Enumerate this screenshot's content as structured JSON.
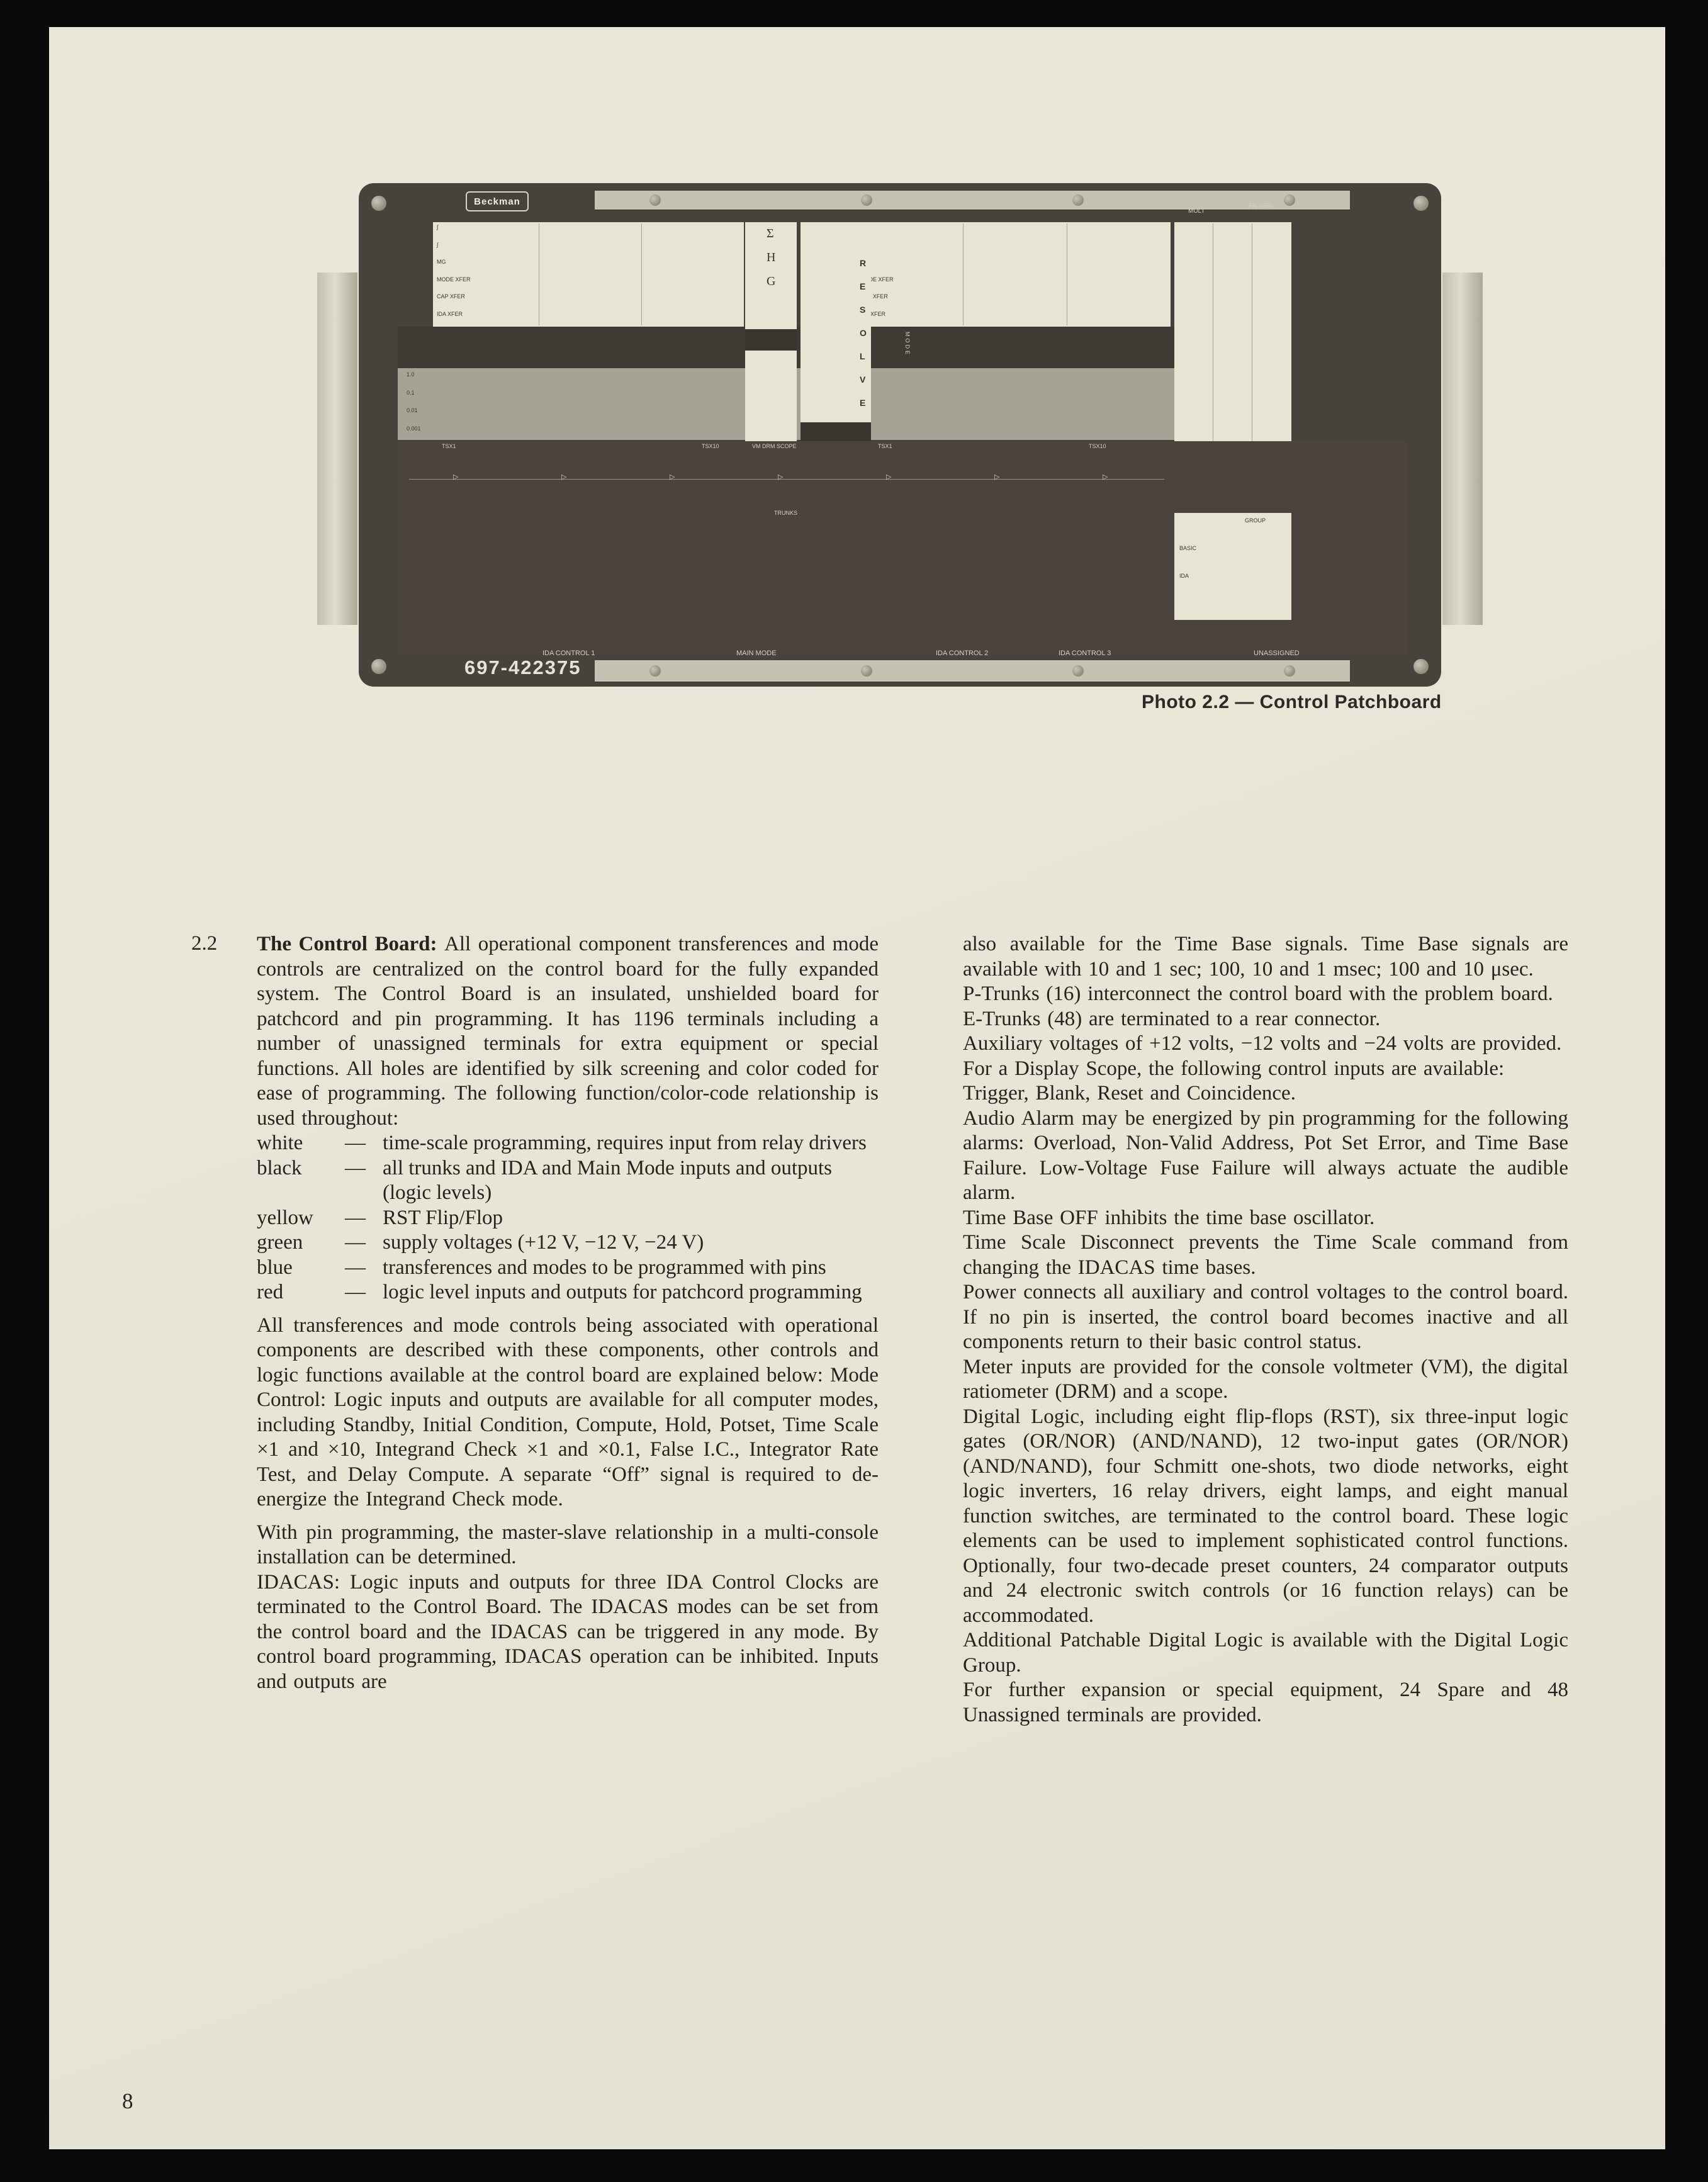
{
  "page": {
    "number": "8"
  },
  "photo": {
    "caption": "Photo 2.2 — Control Patchboard",
    "brand": "Beckman",
    "part_number": "697-422375",
    "row_labels_left": [
      "∫",
      "∫",
      "MG",
      "MODE XFER",
      "CAP XFER",
      "IDA XFER"
    ],
    "row_labels_right": [
      "∫",
      "",
      "MG",
      "MODE XFER",
      "CAP XFER",
      "IDA XFER"
    ],
    "scale_labels": [
      "1.0",
      "0.1",
      "0.01",
      "0.001"
    ],
    "center_glyphs": [
      "Σ",
      "H",
      "G"
    ],
    "resolver_letters": "RESOLVER",
    "band_label": "MODE",
    "top_right_labels": [
      "MULT",
      "FN GEN"
    ],
    "dark_section_labels": [
      "TSX1",
      "TSX10",
      "VM DRM SCOPE",
      "TSX1",
      "TSX10"
    ],
    "trunks_label": "TRUNKS",
    "panel_labels": {
      "group": "GROUP",
      "basic": "BASIC",
      "ida": "IDA"
    },
    "bottom_labels": [
      "IDA CONTROL 1",
      "MAIN MODE",
      "IDA CONTROL 2",
      "IDA CONTROL 3",
      "UNASSIGNED"
    ]
  },
  "article": {
    "section_number": "2.2",
    "left_column": {
      "intro": {
        "lead": "The Control Board:",
        "text": "All operational component transferences and mode controls are centralized on the control board for the fully expanded system. The Control Board is an insulated, unshielded board for patchcord and pin programming. It has 1196 terminals including a number of unassigned terminals for extra equipment or special functions. All holes are identified by silk screening and color coded for ease of programming. The following function/color-code relationship is used throughout:"
      },
      "color_list": [
        {
          "color": "white",
          "desc": "time-scale programming, requires input from relay drivers"
        },
        {
          "color": "black",
          "desc": "all trunks and IDA and Main Mode inputs and outputs (logic levels)"
        },
        {
          "color": "yellow",
          "desc": "RST Flip/Flop"
        },
        {
          "color": "green",
          "desc": "supply voltages (+12 V, −12 V, −24 V)"
        },
        {
          "color": "blue",
          "desc": "transferences and modes to be programmed with pins"
        },
        {
          "color": "red",
          "desc": "logic level inputs and outputs for patchcord programming"
        }
      ],
      "paragraphs": [
        {
          "gap": true,
          "text": "All transferences and mode controls being associated with operational components are described with these components, other controls and logic functions available at the control board are explained below: Mode Control: Logic inputs and outputs are available for all computer modes, including Standby, Initial Condition, Compute, Hold, Potset, Time Scale ×1 and ×10, Integrand Check ×1 and ×0.1, False I.C., Integrator Rate Test, and Delay Compute. A separate “Off” signal is required to de-energize the Integrand Check mode."
        },
        {
          "gap": true,
          "text": "With pin programming, the master-slave relationship in a multi-console installation can be determined."
        },
        {
          "gap": false,
          "text": "IDACAS: Logic inputs and outputs for three IDA Control Clocks are terminated to the Control Board. The IDACAS modes can be set from the control board and the IDACAS can be triggered in any mode. By control board programming, IDACAS operation can be inhibited. Inputs and outputs are"
        }
      ]
    },
    "right_column": {
      "paragraphs": [
        {
          "gap": false,
          "text": "also available for the Time Base signals. Time Base signals are available with 10 and 1 sec; 100, 10 and 1 msec; 100 and 10 μsec."
        },
        {
          "gap": false,
          "text": "P-Trunks (16) interconnect the control board with the problem board."
        },
        {
          "gap": false,
          "text": "E-Trunks (48) are terminated to a rear connector."
        },
        {
          "gap": false,
          "text": "Auxiliary voltages of +12 volts, −12 volts and −24 volts are provided."
        },
        {
          "gap": false,
          "text": "For a Display Scope, the following control inputs are available:"
        },
        {
          "gap": false,
          "text": "Trigger, Blank, Reset and Coincidence."
        },
        {
          "gap": false,
          "text": "Audio Alarm may be energized by pin programming for the following alarms: Overload, Non-Valid Address, Pot Set Error, and Time Base Failure. Low-Voltage Fuse Failure will always actuate the audible alarm."
        },
        {
          "gap": false,
          "text": "Time Base OFF inhibits the time base oscillator."
        },
        {
          "gap": false,
          "text": "Time Scale Disconnect prevents the Time Scale command from changing the IDACAS time bases."
        },
        {
          "gap": false,
          "text": "Power connects all auxiliary and control voltages to the control board. If no pin is inserted, the control board becomes inactive and all components return to their basic control status."
        },
        {
          "gap": false,
          "text": "Meter inputs are provided for the console voltmeter (VM), the digital ratiometer (DRM) and a scope."
        },
        {
          "gap": false,
          "text": "Digital Logic, including eight flip-flops (RST), six three-input logic gates (OR/NOR) (AND/NAND), 12 two-input gates (OR/NOR) (AND/NAND), four Schmitt one-shots, two diode networks, eight logic inverters, 16 relay drivers, eight lamps, and eight manual function switches, are terminated to the control board. These logic elements can be used to implement sophisticated control functions. Optionally, four two-decade preset counters, 24 comparator outputs and 24 electronic switch controls (or 16 function relays) can be accommodated."
        },
        {
          "gap": false,
          "text": "Additional Patchable Digital Logic is available with the Digital Logic Group."
        },
        {
          "gap": false,
          "text": "For further expansion or special equipment, 24 Spare and 48 Unassigned terminals are provided."
        }
      ]
    }
  }
}
